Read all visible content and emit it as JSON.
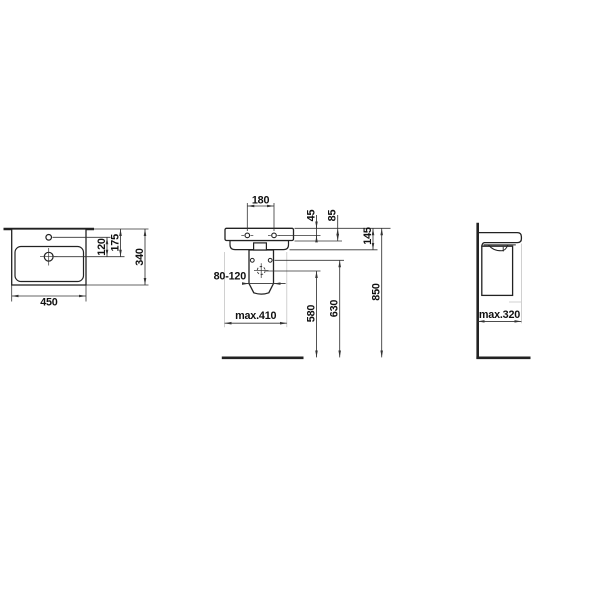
{
  "drawing": {
    "top_view": {
      "width": "450",
      "depth": "340",
      "tap_to_drain": "120",
      "edge_to_drain": "175"
    },
    "front_view": {
      "hole_spacing": "180",
      "edge_to_fixing_holes": "45",
      "rim_height": "85",
      "edge_to_underside": "145",
      "drain_offset_range": "80-120",
      "max_cover_width": "max.410",
      "drain_height": "580",
      "fixing_height": "630",
      "basin_height": "850"
    },
    "side_view": {
      "max_depth": "max.320"
    },
    "colors": {
      "outline": "#222222",
      "dimension": "#333333",
      "light_extension": "#c4c4c4",
      "background": "#ffffff"
    }
  }
}
